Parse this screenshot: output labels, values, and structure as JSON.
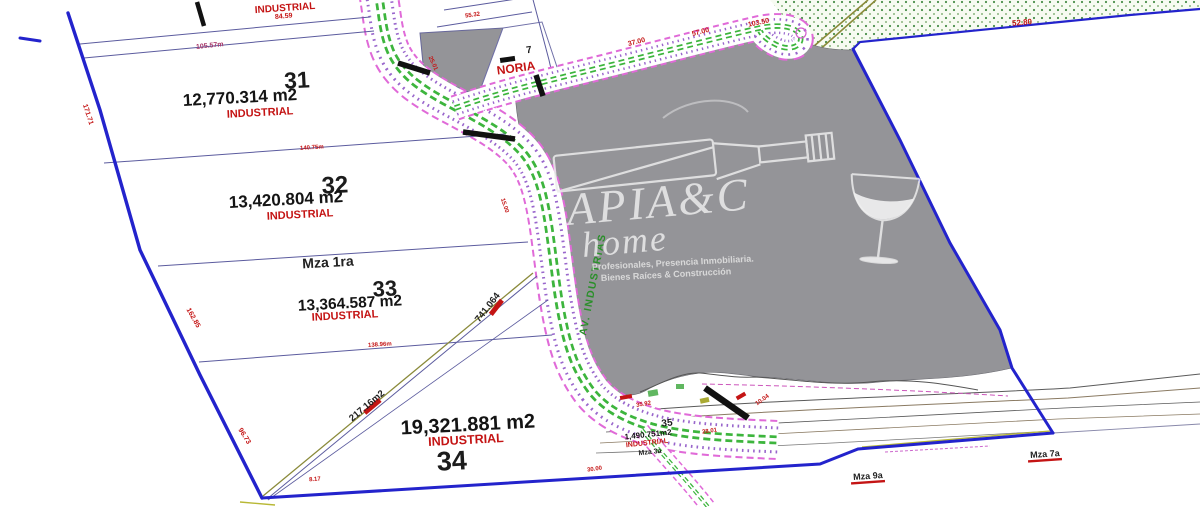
{
  "plan": {
    "zone_top": "INDUSTRIAL",
    "lots": [
      {
        "num": "31",
        "area": "12,770.314 m2",
        "zone": "INDUSTRIAL"
      },
      {
        "num": "32",
        "area": "13,420.804 m2",
        "zone": "INDUSTRIAL"
      },
      {
        "num": "33",
        "area": "13,364.587 m2",
        "zone": "INDUSTRIAL"
      },
      {
        "num": "34",
        "area": "19,321.881 m2",
        "zone": "INDUSTRIAL"
      },
      {
        "num": "35",
        "area": "1,490.751m2",
        "zone": "INDUSTRIAL",
        "block": "Mza 3a"
      },
      {
        "num": "7",
        "label": "NORIA"
      }
    ],
    "blocks": {
      "mza1": "Mza 1ra",
      "mza7": "Mza 7a",
      "mza9": "Mza 9a"
    },
    "roads": {
      "av_industrias": "AV. INDUSTRIAS"
    },
    "dims": {
      "d1": "84.59",
      "d2": "105.57m",
      "d3": "140.75m",
      "d4": "138.96m",
      "d5": "217.16m2",
      "d6": "741.064",
      "d7": "37.00",
      "d8": "57.00",
      "d9": "103.50",
      "d10": "52.80",
      "d11": "171.71",
      "d12": "162.85",
      "d13": "96.73",
      "d14": "35.92",
      "d15": "10.04",
      "d16": "28.01",
      "d17": "15.00",
      "d18": "30.00",
      "d19": "55.32",
      "d20": "25.01",
      "d21": "8.17"
    },
    "watermark": {
      "brand": "APIA&C",
      "brand_sub": "home",
      "tagline1": "Profesionales, Presencia Inmobiliaria.",
      "tagline2": "Bienes Raíces & Construcción"
    },
    "colors": {
      "boundary": "#2323cc",
      "road_edge": "#e06ad8",
      "road_center": "#3db53d",
      "zone_red": "#c41414",
      "gray_fill": "#949498"
    }
  }
}
